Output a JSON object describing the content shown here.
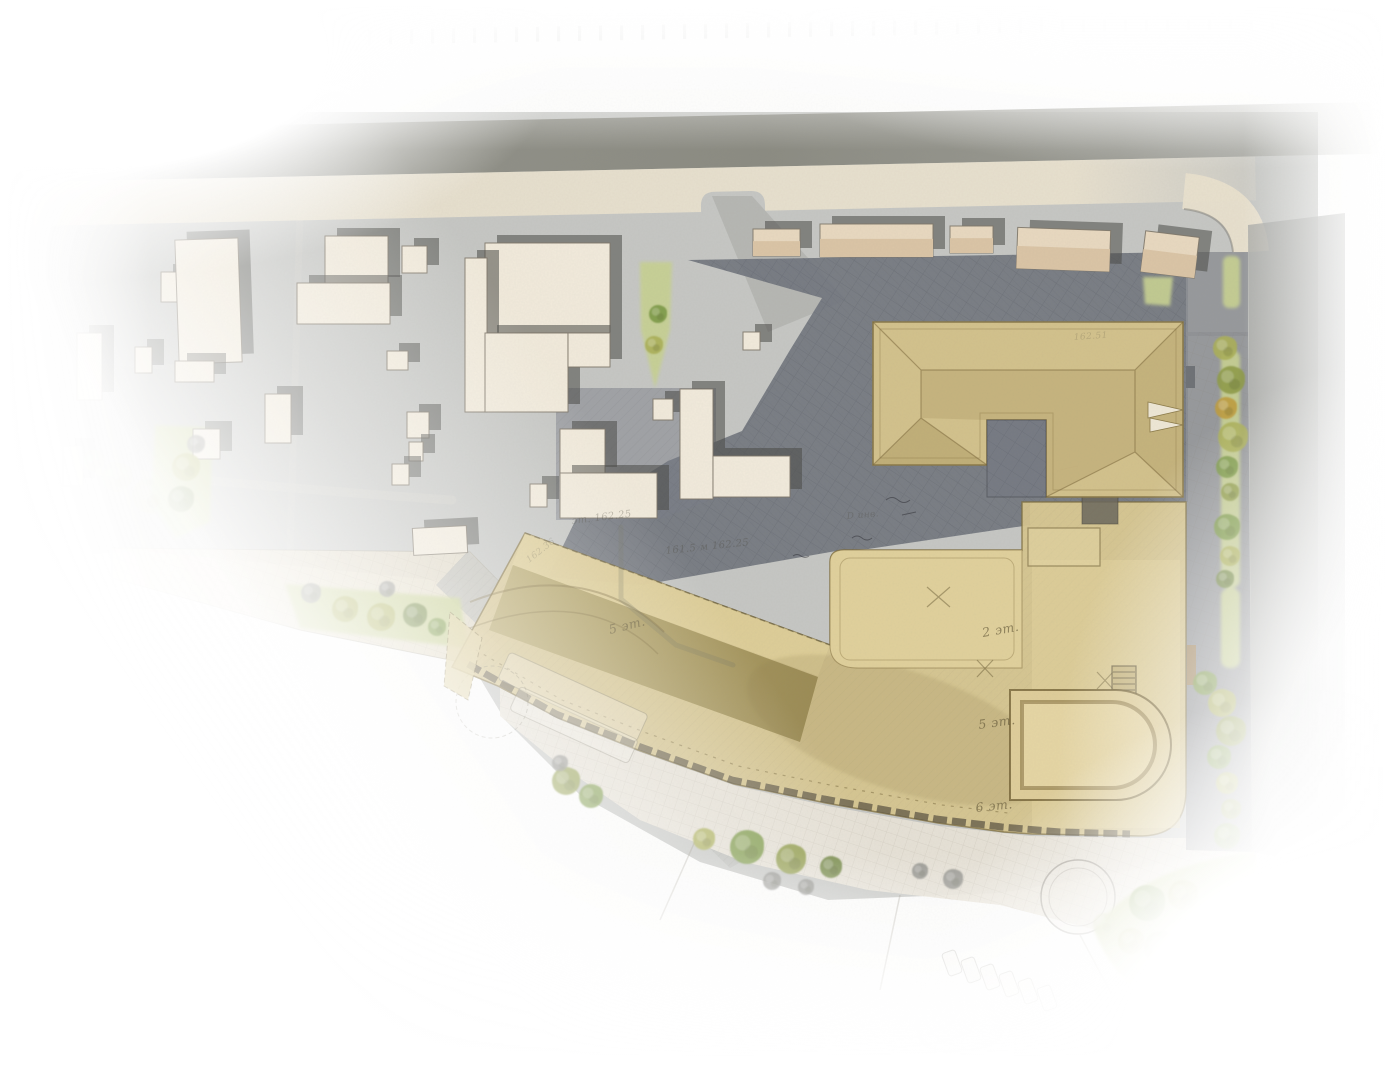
{
  "title": "Watercolor architectural site plan — residential block masterplan",
  "colors": {
    "ground": "#c6c7c4",
    "roadTop": "#8b8b82",
    "sidewalk": "#eae2cf",
    "parkingDark": "#70747d",
    "streetDark": "#8e9095",
    "roadLight": "#a9aaa7",
    "wedge": "#e5ddc9",
    "plaza": "#e9e4d8",
    "lawn": "#c8d193",
    "cream": "#f2ebdc",
    "creamStroke": "#7d766a",
    "buildingShadow": "rgba(72,72,70,0.55)",
    "tanBase": "#d8c68f",
    "tanDarkA": "#b6a76b",
    "tanDarkB": "#93834b",
    "terrace": "#e3d39d",
    "roofU": "#d7c58d",
    "roofStroke": "#8a7947",
    "courtyardDark": "#767a83",
    "ink": "rgba(80,72,50,0.6)"
  },
  "plan": {
    "floor_labels": [
      {
        "text": "5 эт.",
        "x": 610,
        "y": 634,
        "rot": -14
      },
      {
        "text": "2 эт.",
        "x": 983,
        "y": 637,
        "rot": -10
      },
      {
        "text": "5 эт.",
        "x": 979,
        "y": 729,
        "rot": -8
      },
      {
        "text": "6 эт.",
        "x": 976,
        "y": 812,
        "rot": -6
      }
    ],
    "survey_notes": [
      {
        "text": "эт.  162.25",
        "x": 572,
        "y": 524,
        "rot": -7,
        "size": 10,
        "op": 0.6
      },
      {
        "text": "161.5 м 162.25",
        "x": 666,
        "y": 554,
        "rot": -6,
        "size": 10,
        "op": 0.55
      },
      {
        "text": "162.36",
        "x": 529,
        "y": 563,
        "rot": -38,
        "size": 9,
        "op": 0.45
      },
      {
        "text": "D инв.",
        "x": 847,
        "y": 519,
        "rot": -5,
        "size": 9,
        "op": 0.45
      },
      {
        "text": "162.51",
        "x": 1074,
        "y": 340,
        "rot": -4,
        "size": 9,
        "op": 0.35
      }
    ],
    "tree_palette": [
      "#8f9c4a",
      "#abb058",
      "#7d9a45",
      "#6f8440",
      "#bf9d3f",
      "#8b8b86",
      "#c3cc96"
    ],
    "trees": [
      [
        1225,
        348,
        12,
        1
      ],
      [
        1231,
        380,
        14,
        0
      ],
      [
        1226,
        408,
        11,
        4
      ],
      [
        1233,
        437,
        15,
        1
      ],
      [
        1227,
        467,
        11,
        2
      ],
      [
        1230,
        492,
        9,
        0
      ],
      [
        1227,
        527,
        13,
        2
      ],
      [
        1230,
        556,
        10,
        1
      ],
      [
        1225,
        579,
        9,
        3
      ],
      [
        1205,
        683,
        12,
        2
      ],
      [
        1222,
        703,
        14,
        1
      ],
      [
        1231,
        731,
        15,
        0
      ],
      [
        1219,
        757,
        12,
        2
      ],
      [
        1227,
        783,
        11,
        1
      ],
      [
        1231,
        809,
        10,
        0
      ],
      [
        1227,
        836,
        13,
        2
      ],
      [
        1147,
        903,
        18,
        2
      ],
      [
        1183,
        895,
        15,
        1
      ],
      [
        1206,
        927,
        19,
        3
      ],
      [
        1161,
        948,
        17,
        0
      ],
      [
        1131,
        941,
        13,
        1
      ],
      [
        1198,
        962,
        14,
        2
      ],
      [
        1229,
        902,
        10,
        4
      ],
      [
        1104,
        924,
        11,
        6
      ],
      [
        566,
        781,
        14,
        0
      ],
      [
        591,
        796,
        12,
        2
      ],
      [
        704,
        839,
        11,
        1
      ],
      [
        747,
        847,
        17,
        2
      ],
      [
        791,
        859,
        15,
        0
      ],
      [
        831,
        867,
        11,
        3
      ],
      [
        953,
        879,
        10,
        5
      ],
      [
        920,
        871,
        8,
        5
      ],
      [
        560,
        763,
        8,
        5
      ],
      [
        772,
        881,
        9,
        5
      ],
      [
        806,
        887,
        8,
        5
      ],
      [
        311,
        593,
        10,
        5
      ],
      [
        345,
        609,
        13,
        1
      ],
      [
        381,
        617,
        14,
        1
      ],
      [
        415,
        615,
        12,
        3
      ],
      [
        387,
        589,
        8,
        5
      ],
      [
        437,
        627,
        9,
        2
      ],
      [
        186,
        467,
        14,
        1
      ],
      [
        181,
        499,
        13,
        3
      ],
      [
        196,
        444,
        9,
        5
      ],
      [
        117,
        477,
        15,
        6
      ],
      [
        149,
        496,
        17,
        6
      ],
      [
        94,
        461,
        11,
        6
      ],
      [
        658,
        314,
        9,
        2
      ],
      [
        654,
        345,
        9,
        1
      ]
    ],
    "context_buildings": [
      [
        77,
        333,
        25,
        67,
        0,
        0
      ],
      [
        135,
        347,
        17,
        26,
        0,
        0
      ],
      [
        161,
        272,
        16,
        30,
        0,
        0
      ],
      [
        177,
        239,
        63,
        124,
        -2,
        0
      ],
      [
        175,
        361,
        39,
        21,
        0,
        0
      ],
      [
        265,
        394,
        26,
        49,
        0,
        0
      ],
      [
        193,
        429,
        27,
        30,
        0,
        0
      ],
      [
        325,
        236,
        63,
        49,
        0,
        0
      ],
      [
        297,
        283,
        93,
        41,
        0,
        0
      ],
      [
        402,
        246,
        25,
        27,
        0,
        0
      ],
      [
        387,
        351,
        21,
        19,
        0,
        0
      ],
      [
        407,
        412,
        22,
        26,
        0,
        0
      ],
      [
        409,
        442,
        14,
        19,
        0,
        0
      ],
      [
        392,
        464,
        17,
        21,
        0,
        0
      ],
      [
        485,
        243,
        125,
        90,
        0,
        0
      ],
      [
        465,
        258,
        22,
        154,
        0,
        0
      ],
      [
        485,
        333,
        83,
        79,
        0,
        0
      ],
      [
        568,
        333,
        42,
        34,
        0,
        0
      ],
      [
        413,
        527,
        54,
        27,
        -3,
        0
      ],
      [
        530,
        484,
        17,
        23,
        0,
        0
      ],
      [
        560,
        429,
        45,
        46,
        0,
        0
      ],
      [
        560,
        473,
        97,
        45,
        0,
        0
      ],
      [
        653,
        399,
        20,
        21,
        0,
        0
      ],
      [
        680,
        389,
        33,
        110,
        0,
        0
      ],
      [
        713,
        456,
        77,
        41,
        0,
        0
      ],
      [
        743,
        332,
        17,
        18,
        0,
        0
      ],
      [
        753,
        229,
        47,
        27,
        0,
        1
      ],
      [
        820,
        224,
        113,
        33,
        0,
        1
      ],
      [
        950,
        226,
        43,
        27,
        0,
        1
      ],
      [
        1017,
        229,
        93,
        41,
        2,
        1
      ],
      [
        1143,
        234,
        54,
        41,
        7,
        1
      ],
      [
        63,
        446,
        20,
        40,
        0,
        2
      ]
    ]
  }
}
